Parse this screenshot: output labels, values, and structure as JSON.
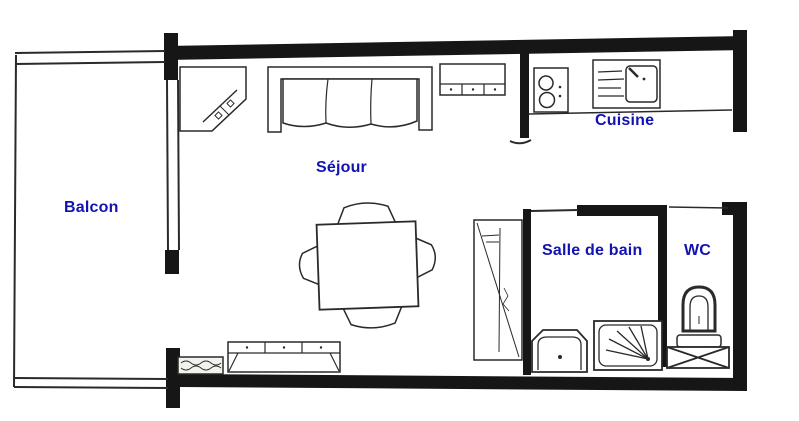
{
  "document": {
    "type": "apartment-floor-plan",
    "background_color": "#ffffff",
    "wall_color": "#161616",
    "line_color": "#2a2a2a",
    "label_color": "#1212b2"
  },
  "rooms": [
    {
      "id": "balcon",
      "label": "Balcon"
    },
    {
      "id": "sejour",
      "label": "Séjour"
    },
    {
      "id": "cuisine",
      "label": "Cuisine"
    },
    {
      "id": "salle_de_bain",
      "label": "Salle de bain"
    },
    {
      "id": "wc",
      "label": "WC"
    }
  ],
  "furniture_icons": [
    {
      "room": "sejour",
      "name": "corner-cabinet-icon"
    },
    {
      "room": "sejour",
      "name": "sofa-icon"
    },
    {
      "room": "sejour",
      "name": "wall-cabinet-icon"
    },
    {
      "room": "sejour",
      "name": "dining-table-icon"
    },
    {
      "room": "sejour",
      "name": "chair-icon"
    },
    {
      "room": "sejour",
      "name": "tall-closet-icon"
    },
    {
      "room": "sejour",
      "name": "sideboard-icon"
    },
    {
      "room": "sejour",
      "name": "radiator-icon"
    },
    {
      "room": "cuisine",
      "name": "hob-icon"
    },
    {
      "room": "cuisine",
      "name": "sink-icon"
    },
    {
      "room": "salle_de_bain",
      "name": "washbasin-icon"
    },
    {
      "room": "salle_de_bain",
      "name": "shower-icon"
    },
    {
      "room": "wc",
      "name": "toilet-icon"
    },
    {
      "room": "wc",
      "name": "crossed-storage-icon"
    }
  ]
}
